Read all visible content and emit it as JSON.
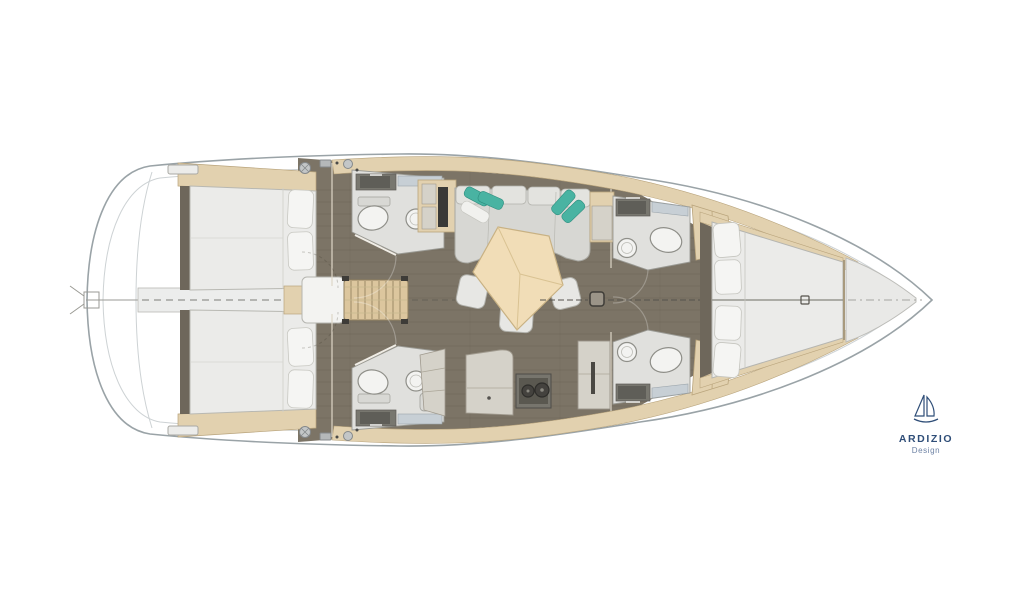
{
  "plan": {
    "type": "sailing-yacht-interior-floor-plan",
    "orientation": "bow-right",
    "areas": [
      "transom-swim-platform",
      "aft-cabin-port",
      "aft-cabin-starboard",
      "aft-head-port",
      "aft-head-starboard",
      "companionway-stairs",
      "engine-box",
      "salon-sofa",
      "salon-table",
      "galley",
      "forward-head-port",
      "forward-head-starboard",
      "forward-cabin",
      "bow-anchor-locker"
    ],
    "fixtures": [
      "toilet",
      "round-sink",
      "counter-sink",
      "stove-two-burners",
      "fridge",
      "mast-post",
      "winches",
      "liferaft"
    ]
  },
  "logo": {
    "brand": "ARDIZIO",
    "subtitle": "Design"
  },
  "colors": {
    "hull_outline": "#9aa3a7",
    "deck_line": "#cdd2d4",
    "floor": "#7c7466",
    "floor_plank": "#675f52",
    "corridor": "#ecedec",
    "wood_tan": "#e2d1af",
    "wood_tan_edge": "#b9a47c",
    "stairs": "#dcc69e",
    "mattress": "#ebebe9",
    "pillow": "#f5f5f3",
    "sofa": "#d7d7d3",
    "sofa_back": "#e3e3df",
    "teal_cushion": "#49b3a2",
    "table_wood": "#f1ddb7",
    "table_edge": "#c8b183",
    "stool": "#e7e7e4",
    "bath_floor": "#e0e0dd",
    "counter_dark": "#78776f",
    "sink_basin": "#5f5e58",
    "glass": "#c7cfd5",
    "fixture": "#f3f3f1",
    "fixture_edge": "#8f8f89",
    "stove": "#5a5850",
    "stove_panel": "#77756d",
    "cabinet_gray": "#d5d2c9",
    "dark_wood": "#6e675b",
    "locker": "#e9e9e7",
    "engine_box": "#f3f3f1",
    "logo_navy": "#2f4e78",
    "logo_light": "#6d82a4"
  }
}
